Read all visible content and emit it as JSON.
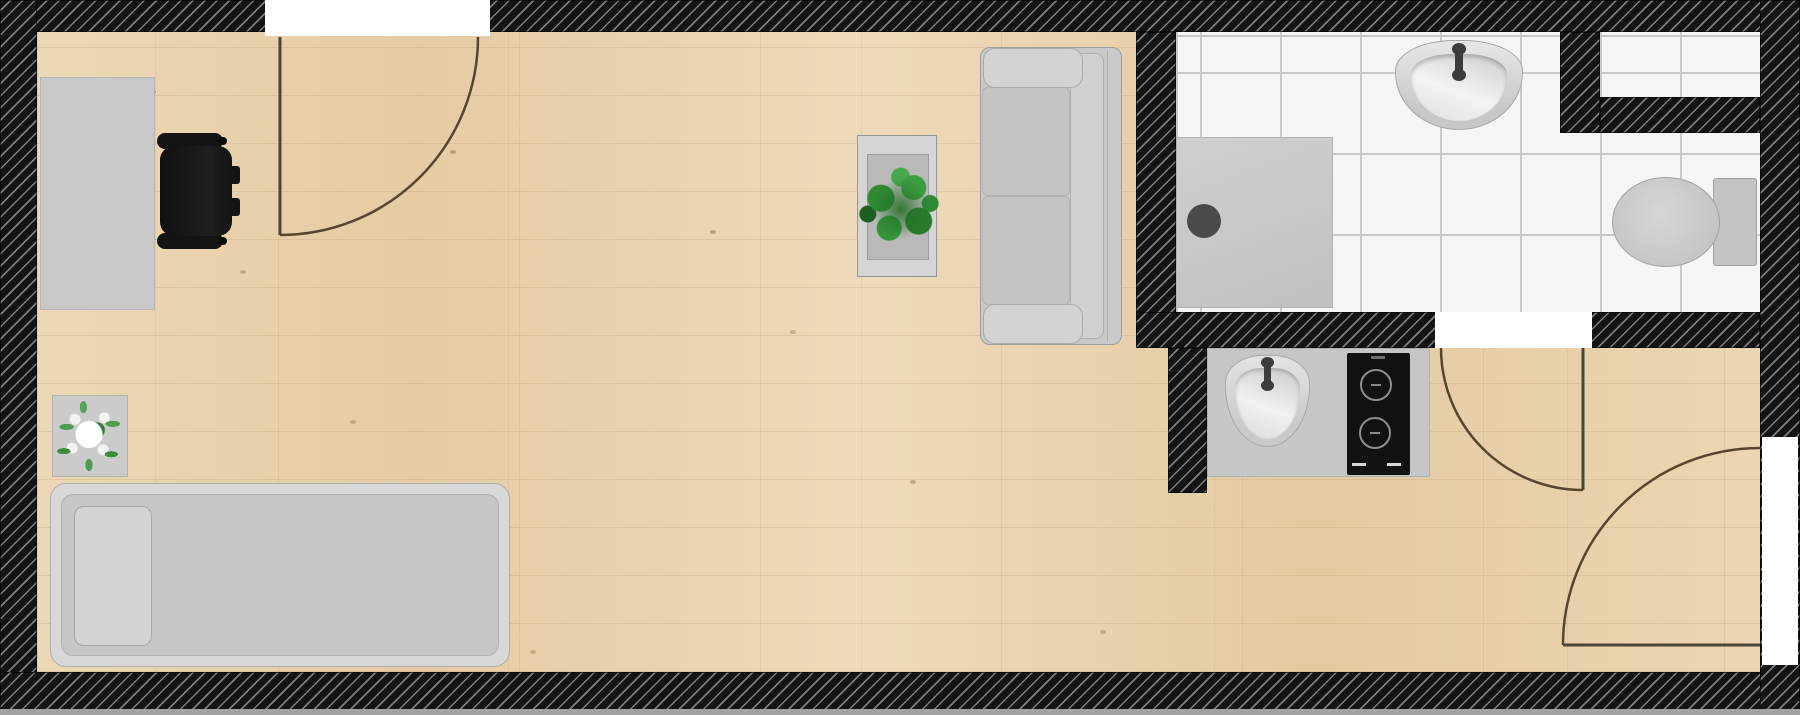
{
  "plan": {
    "title": "Studio apartment floor plan",
    "rooms": [
      {
        "name": "living-room",
        "floor": "light-wood-plank"
      },
      {
        "name": "bathroom",
        "floor": "white-tile"
      },
      {
        "name": "kitchenette",
        "floor": "light-wood-plank"
      }
    ],
    "walls": {
      "style": "black-diagonal-hatch",
      "color": "#141414",
      "stripe_color": "#7d7d7d"
    },
    "doors": [
      {
        "name": "top-door",
        "wall": "top",
        "swing": "quarter-arc-into-room"
      },
      {
        "name": "bathroom-door",
        "wall": "bathroom-bottom",
        "swing": "quarter-arc-into-hall"
      },
      {
        "name": "entry-door",
        "wall": "right",
        "swing": "quarter-arc-into-room"
      }
    ],
    "furniture": [
      {
        "name": "desk",
        "color": "#c8c8c8"
      },
      {
        "name": "wheelchair",
        "color": "#161616"
      },
      {
        "name": "side-table-with-flower-plant",
        "color": "#cbcbcb",
        "plant_color": "#3c8c40",
        "flower_color": "#ffffff"
      },
      {
        "name": "single-bed-with-pillow",
        "color": "#c6c6c6"
      },
      {
        "name": "coffee-table-with-plant",
        "color": "#d5d5d5",
        "plant_color": "#2f8a33"
      },
      {
        "name": "sofa",
        "color": "#c9c9c9"
      }
    ],
    "fixtures": [
      {
        "name": "shower-tray-with-drain",
        "color": "#c9c9c9",
        "drain_color": "#4a4a4a"
      },
      {
        "name": "bathroom-wash-basin",
        "color": "#d9d9d9",
        "faucet_color": "#3c3c3c"
      },
      {
        "name": "toilet-with-cistern",
        "color": "#c9c9c9"
      },
      {
        "name": "kitchen-counter",
        "color": "#c6c6c6"
      },
      {
        "name": "kitchen-sink",
        "color": "#d9d9d9"
      },
      {
        "name": "induction-cooktop",
        "color": "#121212",
        "burners": 2
      }
    ],
    "colors": {
      "floor_wood": "#e9d1ae",
      "tile": "#f3f6f5",
      "grout": "#c6cbca",
      "door_opening": "#ffffff",
      "door_arc": "#57452d",
      "bottom_edge_strip": "#a2a2a2"
    }
  }
}
